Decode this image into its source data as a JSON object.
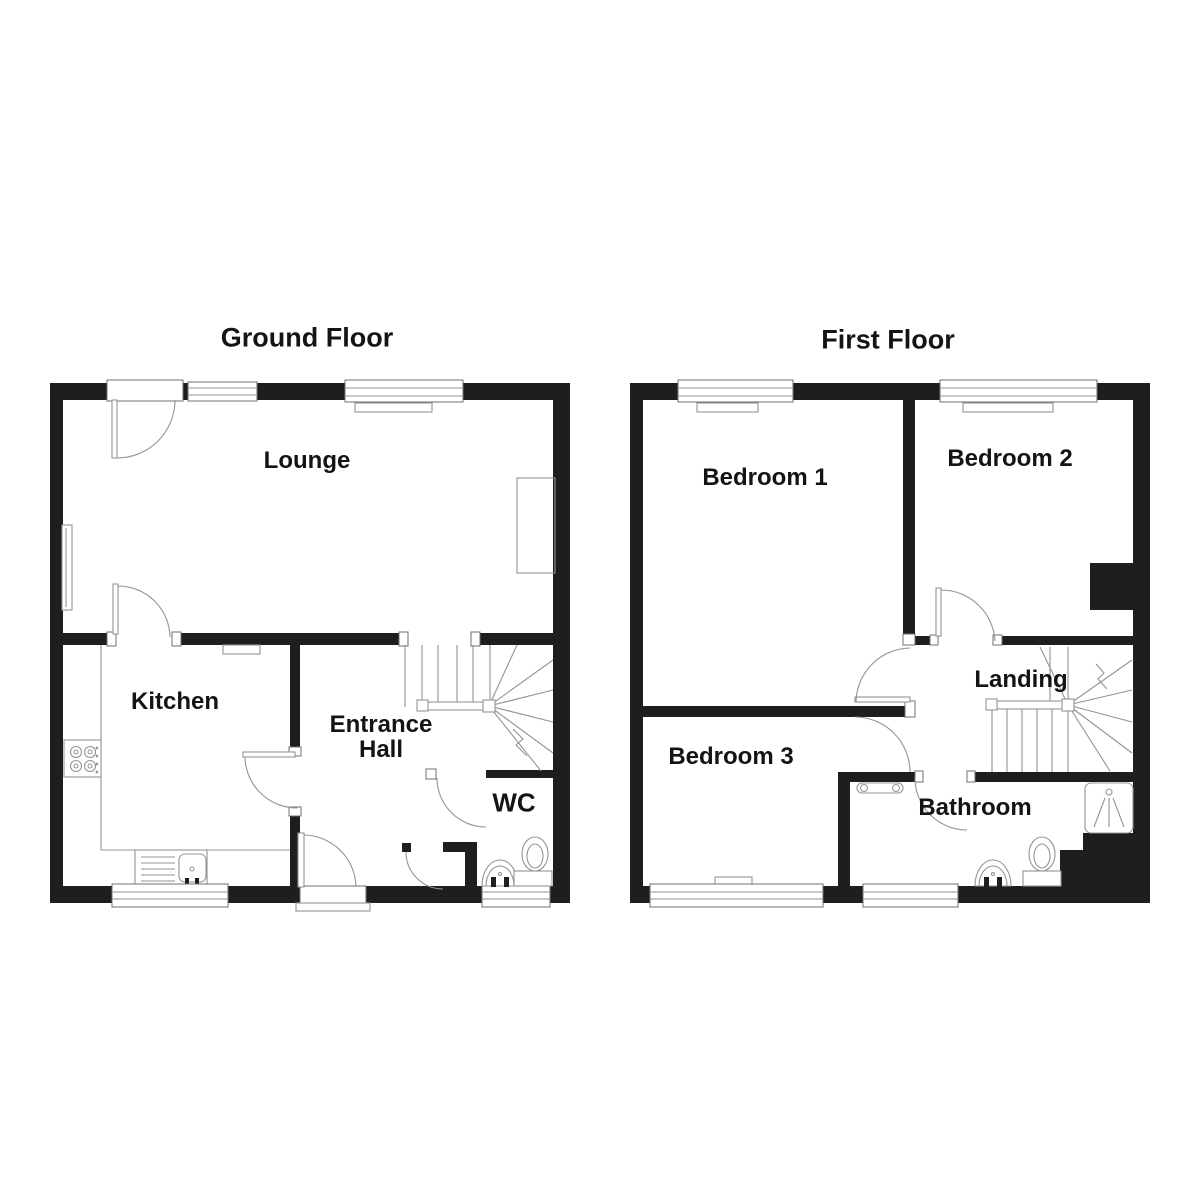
{
  "document": {
    "type": "floorplan"
  },
  "colors": {
    "wall": "#1e1e1e",
    "line": "#949494",
    "frame": "#6f6f6f",
    "text": "#141414"
  },
  "ground_floor": {
    "title": "Ground Floor",
    "rooms": [
      {
        "name": "Lounge"
      },
      {
        "name": "Kitchen"
      },
      {
        "name": "Entrance Hall"
      },
      {
        "name": "WC"
      }
    ]
  },
  "first_floor": {
    "title": "First Floor",
    "rooms": [
      {
        "name": "Bedroom 1"
      },
      {
        "name": "Bedroom 2"
      },
      {
        "name": "Bedroom 3"
      },
      {
        "name": "Landing"
      },
      {
        "name": "Bathroom"
      }
    ]
  }
}
